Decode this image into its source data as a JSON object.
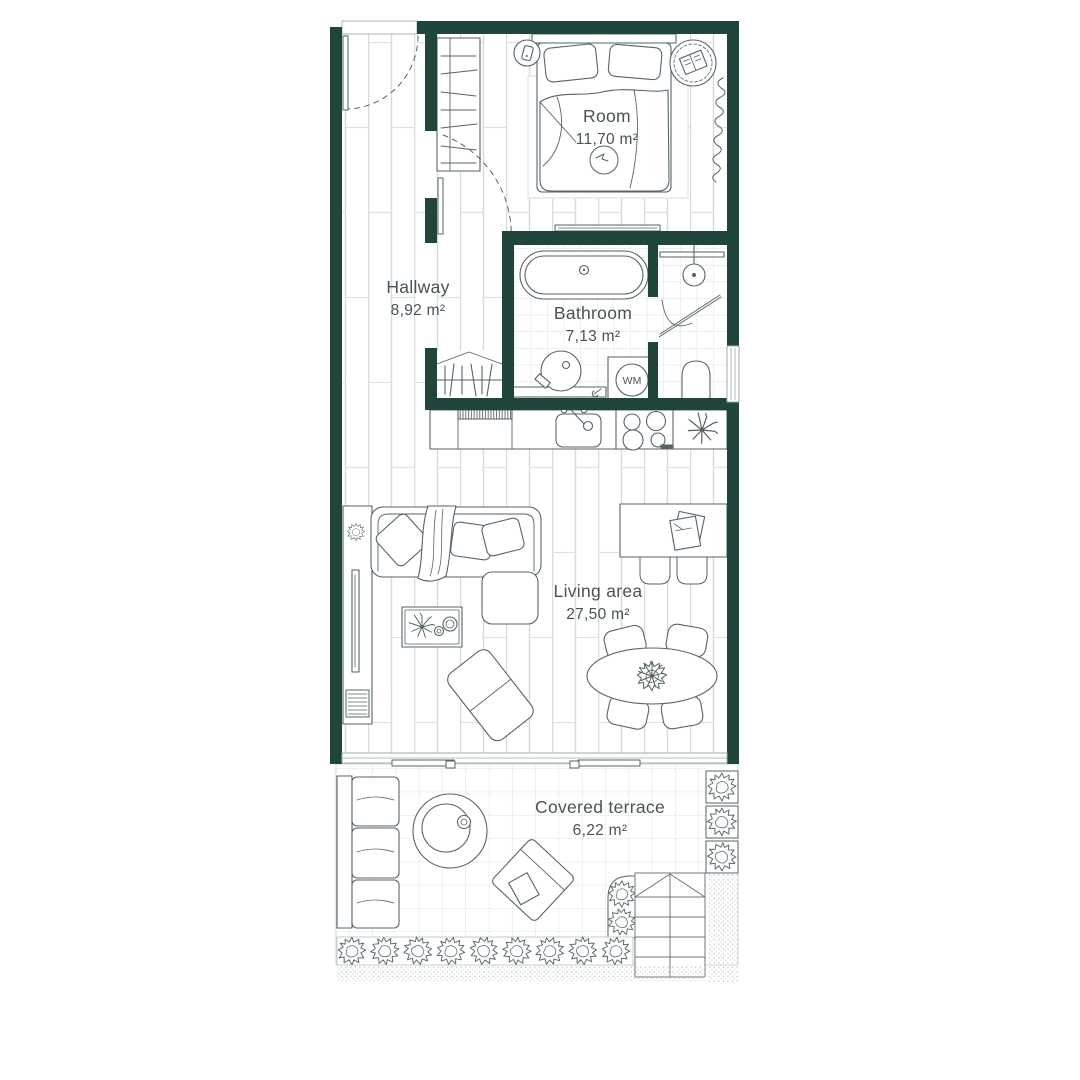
{
  "title": "Apartment floor plan",
  "colors": {
    "wall": "#20453d",
    "furniture_line": "#56665f",
    "text": "#47554f",
    "floor_line": "#d5dcd8",
    "tile_line": "#dfe5e2"
  },
  "rooms": {
    "bedroom": {
      "name": "Room",
      "area": "11,70 m²"
    },
    "hallway": {
      "name": "Hallway",
      "area": "8,92 m²"
    },
    "bathroom": {
      "name": "Bathroom",
      "area": "7,13 m²",
      "wm_label": "WM"
    },
    "living": {
      "name": "Living area",
      "area": "27,50 m²"
    },
    "terrace": {
      "name": "Covered terrace",
      "area": "6,22 m²"
    }
  }
}
